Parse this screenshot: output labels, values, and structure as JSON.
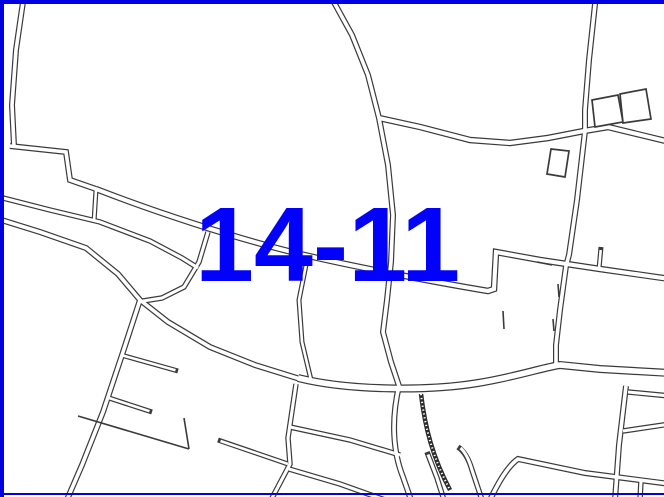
{
  "map": {
    "label": "14-11",
    "label_color": "#0202fb",
    "frame_color": "#0000e0",
    "line_color": "#3a3a3a",
    "road_fill": "#ffffff",
    "background": "#ffffff",
    "embankment_color": "#2b2b2b",
    "roads": [
      {
        "name": "road-topleft-vertical",
        "w": 6,
        "d": "M 24 -5 L 16 50 L 12 105 L 14 146"
      },
      {
        "name": "road-step",
        "w": 6,
        "d": "M 10 146 L 66 152 L 70 180 L 96 189"
      },
      {
        "name": "road-main-diagonal",
        "w": 6.5,
        "d": "M 96 189 C 150 210 230 237 300 254 C 360 268 440 283 488 291 L 494 289 L 496 252 L 540 260 L 560 263 L 600 269 L 670 279"
      },
      {
        "name": "road-stub-north",
        "w": 5,
        "d": "M 599 269 L 601 247",
        "d2": "M 599 269 L 600.7 250"
      },
      {
        "name": "road-upper-left-a",
        "w": 5.5,
        "d": "M -5 196 L 50 210 L 100 222 L 150 241 L 182 258 L 198 268"
      },
      {
        "name": "road-upper-left-b",
        "w": 6,
        "d": "M -5 218 L 40 232 L 86 248 L 118 274 L 140 300 L 168 322 L 210 347 L 255 365 L 300 379"
      },
      {
        "name": "road-branch-ne",
        "w": 5.5,
        "d": "M 208 232 L 199 262 L 184 287 L 162 298 L 143 301"
      },
      {
        "name": "road-connector",
        "w": 5,
        "d": "M 96 190 L 94 222"
      },
      {
        "name": "road-sw-diagonal",
        "w": 6,
        "d": "M 140 300 L 122 355 L 103 412 L 82 465 L 66 502"
      },
      {
        "name": "road-stub-ne-1",
        "w": 5,
        "d": "M 121 355 L 178 371",
        "d2": "M 121 355 L 175.5 370.3"
      },
      {
        "name": "road-stub-ne-2",
        "w": 5,
        "d": "M 109 398 L 152 412",
        "d2": "M 109 398 L 149.5 411.2"
      },
      {
        "name": "road-center-s1",
        "w": 5,
        "d": "M 308 255 L 299 300 L 302 342 L 311 380"
      },
      {
        "name": "road-north-vertical",
        "w": 6,
        "d": "M 330 -5 L 352 35 L 368 75 L 379 118 L 388 165 L 393 215 L 391 262 L 387 300 L 383 332 L 391 362 L 399 386 C 391 420 393 452 403 477 L 411 500"
      },
      {
        "name": "road-ew-upper",
        "w": 6.5,
        "d": "M 379 118 L 420 127 L 470 140 L 510 143 L 548 138 L 584 131 L 608 127 L 670 142"
      },
      {
        "name": "road-north-right",
        "w": 6,
        "d": "M 596 -5 L 589 60 L 585 110 L 585 131 L 577 200 L 569 255 L 566 266 L 560 310 L 556 345 L 556 368"
      },
      {
        "name": "road-ew-main",
        "w": 8,
        "d": "M 298 378 C 350 391 430 391 478 383 C 515 377 545 367 560 365 L 600 369 L 670 373"
      },
      {
        "name": "road-b1",
        "w": 5.5,
        "d": "M 296 384 L 288 438 L 290 464 L 271 500"
      },
      {
        "name": "road-stub-nw",
        "w": 5,
        "d": "M 218 440 L 288 464",
        "d2": "M 220.5 441 L 288 464"
      },
      {
        "name": "road-b2-upper",
        "w": 5.5,
        "d": "M 290 427 L 350 440 L 400 455"
      },
      {
        "name": "road-b2-lower",
        "w": 5.5,
        "d": "M 289 469 L 340 484 L 385 500"
      },
      {
        "name": "road-right-vertical",
        "w": 6,
        "d": "M 626 386 L 619 445 L 615 500"
      },
      {
        "name": "road-right-east-1",
        "w": 5.5,
        "d": "M 628 392 L 670 396"
      },
      {
        "name": "road-right-east-2",
        "w": 5.5,
        "d": "M 623 431 L 670 424"
      },
      {
        "name": "road-x-diagonal",
        "w": 6,
        "d": "M 490 500 Q 505 468 518 459 L 585 473 L 670 484"
      },
      {
        "name": "road-x-south",
        "w": 5.5,
        "d": "M 641 480 L 640 500"
      },
      {
        "name": "road-stub-hook-1",
        "w": 5.5,
        "d": "M 444 500 L 437 478 L 427 452",
        "d2": "M 444 500 L 437 478 L 428 454.5"
      },
      {
        "name": "road-stub-hook-2",
        "w": 5.5,
        "d": "M 482 500 L 472 470 Q 467 453 458 447",
        "d2": "M 482 500 L 472 470 Q 467.4 454 460.5 448"
      }
    ],
    "parcel_lines": [
      {
        "name": "parcel-line-vertical",
        "d": "M 184 418 L 189 449"
      },
      {
        "name": "parcel-line-diagonal",
        "d": "M 78 416 L 189 449"
      },
      {
        "name": "tick-1",
        "d": "M 503 311 L 504 329"
      },
      {
        "name": "tick-2",
        "d": "M 558 284 L 559 297"
      },
      {
        "name": "tick-3",
        "d": "M 553 319 L 554 331"
      },
      {
        "name": "tick-4",
        "d": "M 537 262 L 552 265"
      }
    ],
    "buildings": [
      {
        "name": "building-1",
        "points": "592,100 618,95 623,122 595,127"
      },
      {
        "name": "building-2",
        "points": "620,94 646,89 651,119 623,123"
      },
      {
        "name": "building-3",
        "points": "551,149 569,151 565,177 547,174"
      }
    ],
    "embankment": {
      "name": "embankment-slope",
      "d": "M 421 394 C 425 428 433 458 450 490",
      "w": 4.5
    }
  }
}
